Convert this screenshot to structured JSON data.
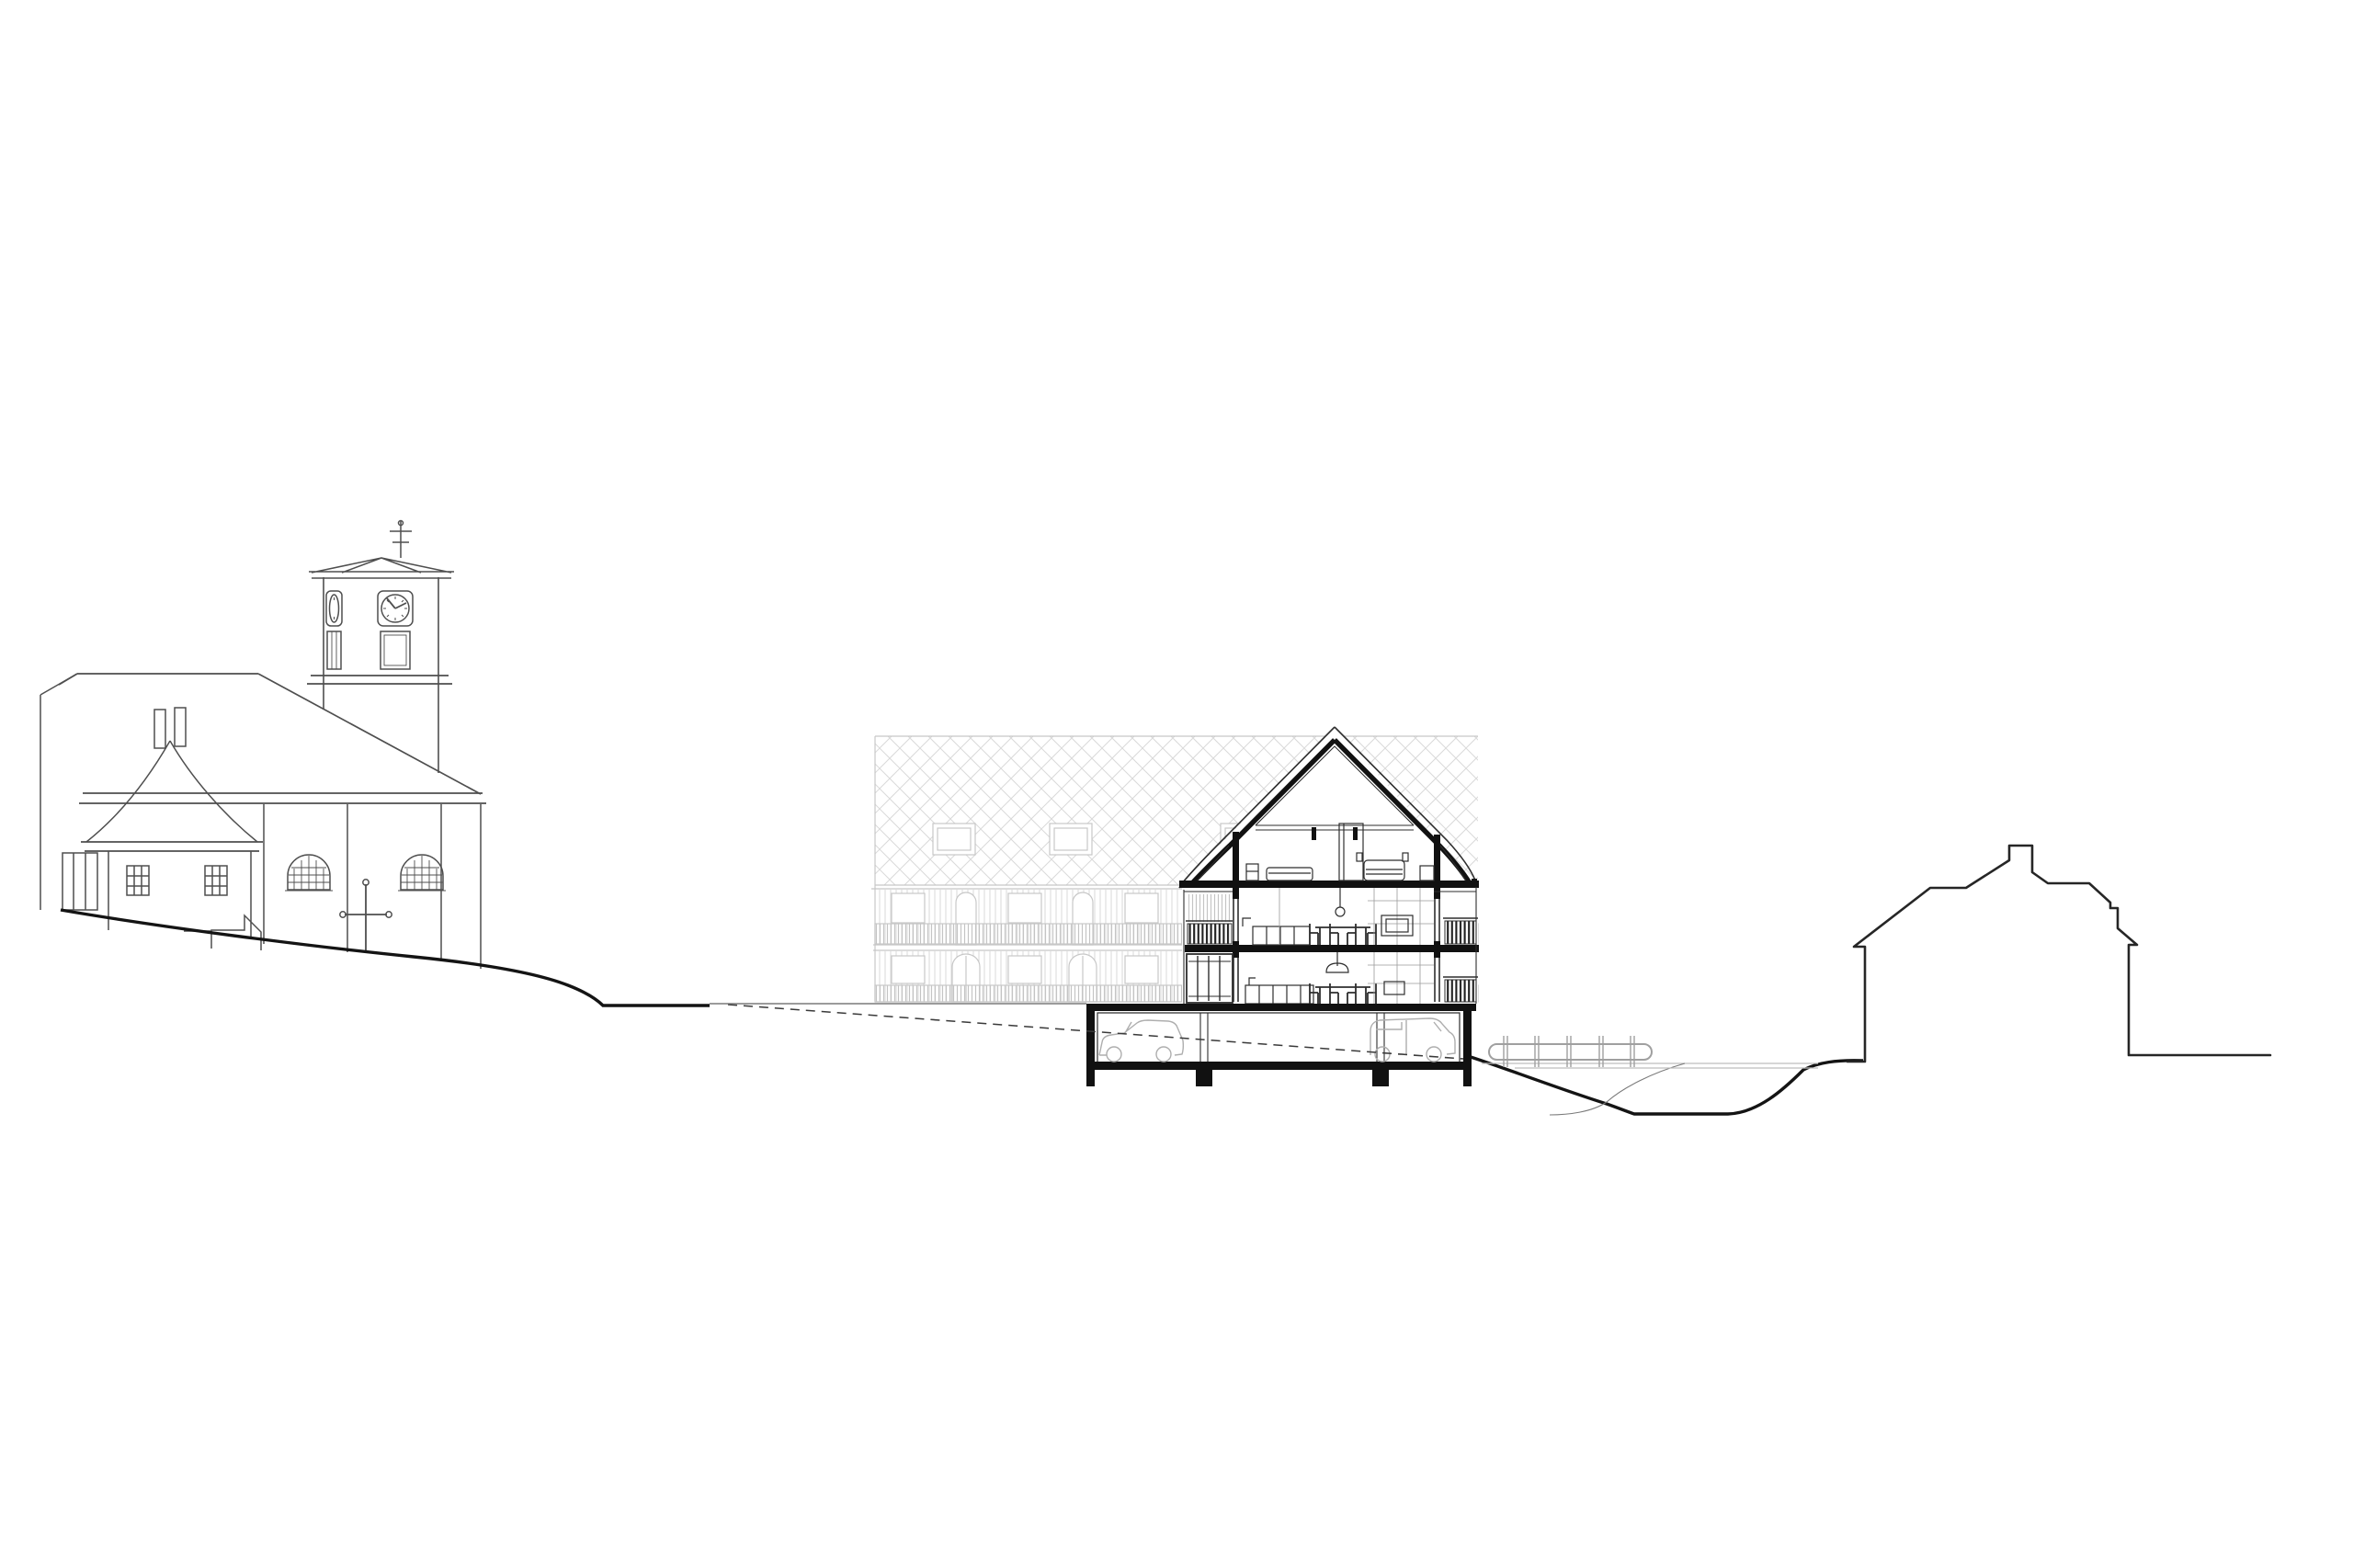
{
  "page": {
    "title": "Architectural site section and elevation drawing",
    "background": "#ffffff"
  },
  "colors": {
    "church_ink": "#4f4f4f",
    "section_ink": "#1d1d1d",
    "section_thin": "#2e2e2e",
    "section_light": "#9a9a9a",
    "poche": "#111111",
    "faded_ink": "#c7c7c7",
    "faded_light": "#d9d9d9",
    "faded_slat": "#c4c4c4",
    "dark_slat": "#1f1f1f",
    "terrain_ink": "#141414",
    "terrain_thin": "#7a7a7a",
    "car_ink": "#aeaeae",
    "bridge_ink": "#a0a0a0",
    "deck_ink": "#bdbdbd",
    "silhouette_ink": "#262626",
    "dashed_ink": "#3a3a3a",
    "white": "#ffffff"
  },
  "scene": {
    "type": "architectural-section-elevation",
    "elements": [
      "church-elevation-with-clock-tower",
      "church-tower-clock",
      "church-weathervane",
      "side-chapel-with-chimneys",
      "wayside-cross",
      "faded-neighbor-building-elevation",
      "diamond-shingle-roof",
      "dormer-windows",
      "balcony-slat-railings",
      "sectioned-residential-building",
      "attic-bedroom-with-beds",
      "upper-floor-dining-room",
      "ground-floor-kitchen",
      "pendant-lamps",
      "underground-parking-garage",
      "two-cars",
      "dashed-ramp-line",
      "footbridge-over-stream",
      "terrain-profile",
      "right-house-silhouette"
    ]
  }
}
